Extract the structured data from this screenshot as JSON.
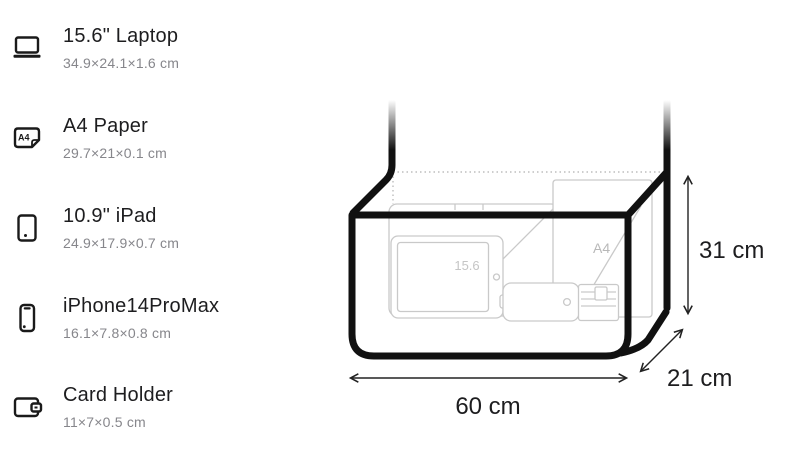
{
  "items": [
    {
      "name": "15.6\" Laptop",
      "dims": "34.9×24.1×1.6 cm"
    },
    {
      "name": "A4 Paper",
      "dims": "29.7×21×0.1 cm",
      "icon_label": "A4"
    },
    {
      "name": "10.9\" iPad",
      "dims": "24.9×17.9×0.7 cm"
    },
    {
      "name": "iPhone14ProMax",
      "dims": "16.1×7.8×0.8 cm"
    },
    {
      "name": "Card Holder",
      "dims": "11×7×0.5 cm"
    }
  ],
  "diagram": {
    "width": "60 cm",
    "height": "31 cm",
    "depth": "21 cm",
    "laptop_label": "15.6",
    "paper_label": "A4"
  },
  "colors": {
    "outline": "#111111",
    "sketch": "#c9c9c9",
    "sketch_label": "#bdbdbd",
    "title_text": "#1d1d1f",
    "secondary_text": "#86868b",
    "arrow": "#222222"
  }
}
